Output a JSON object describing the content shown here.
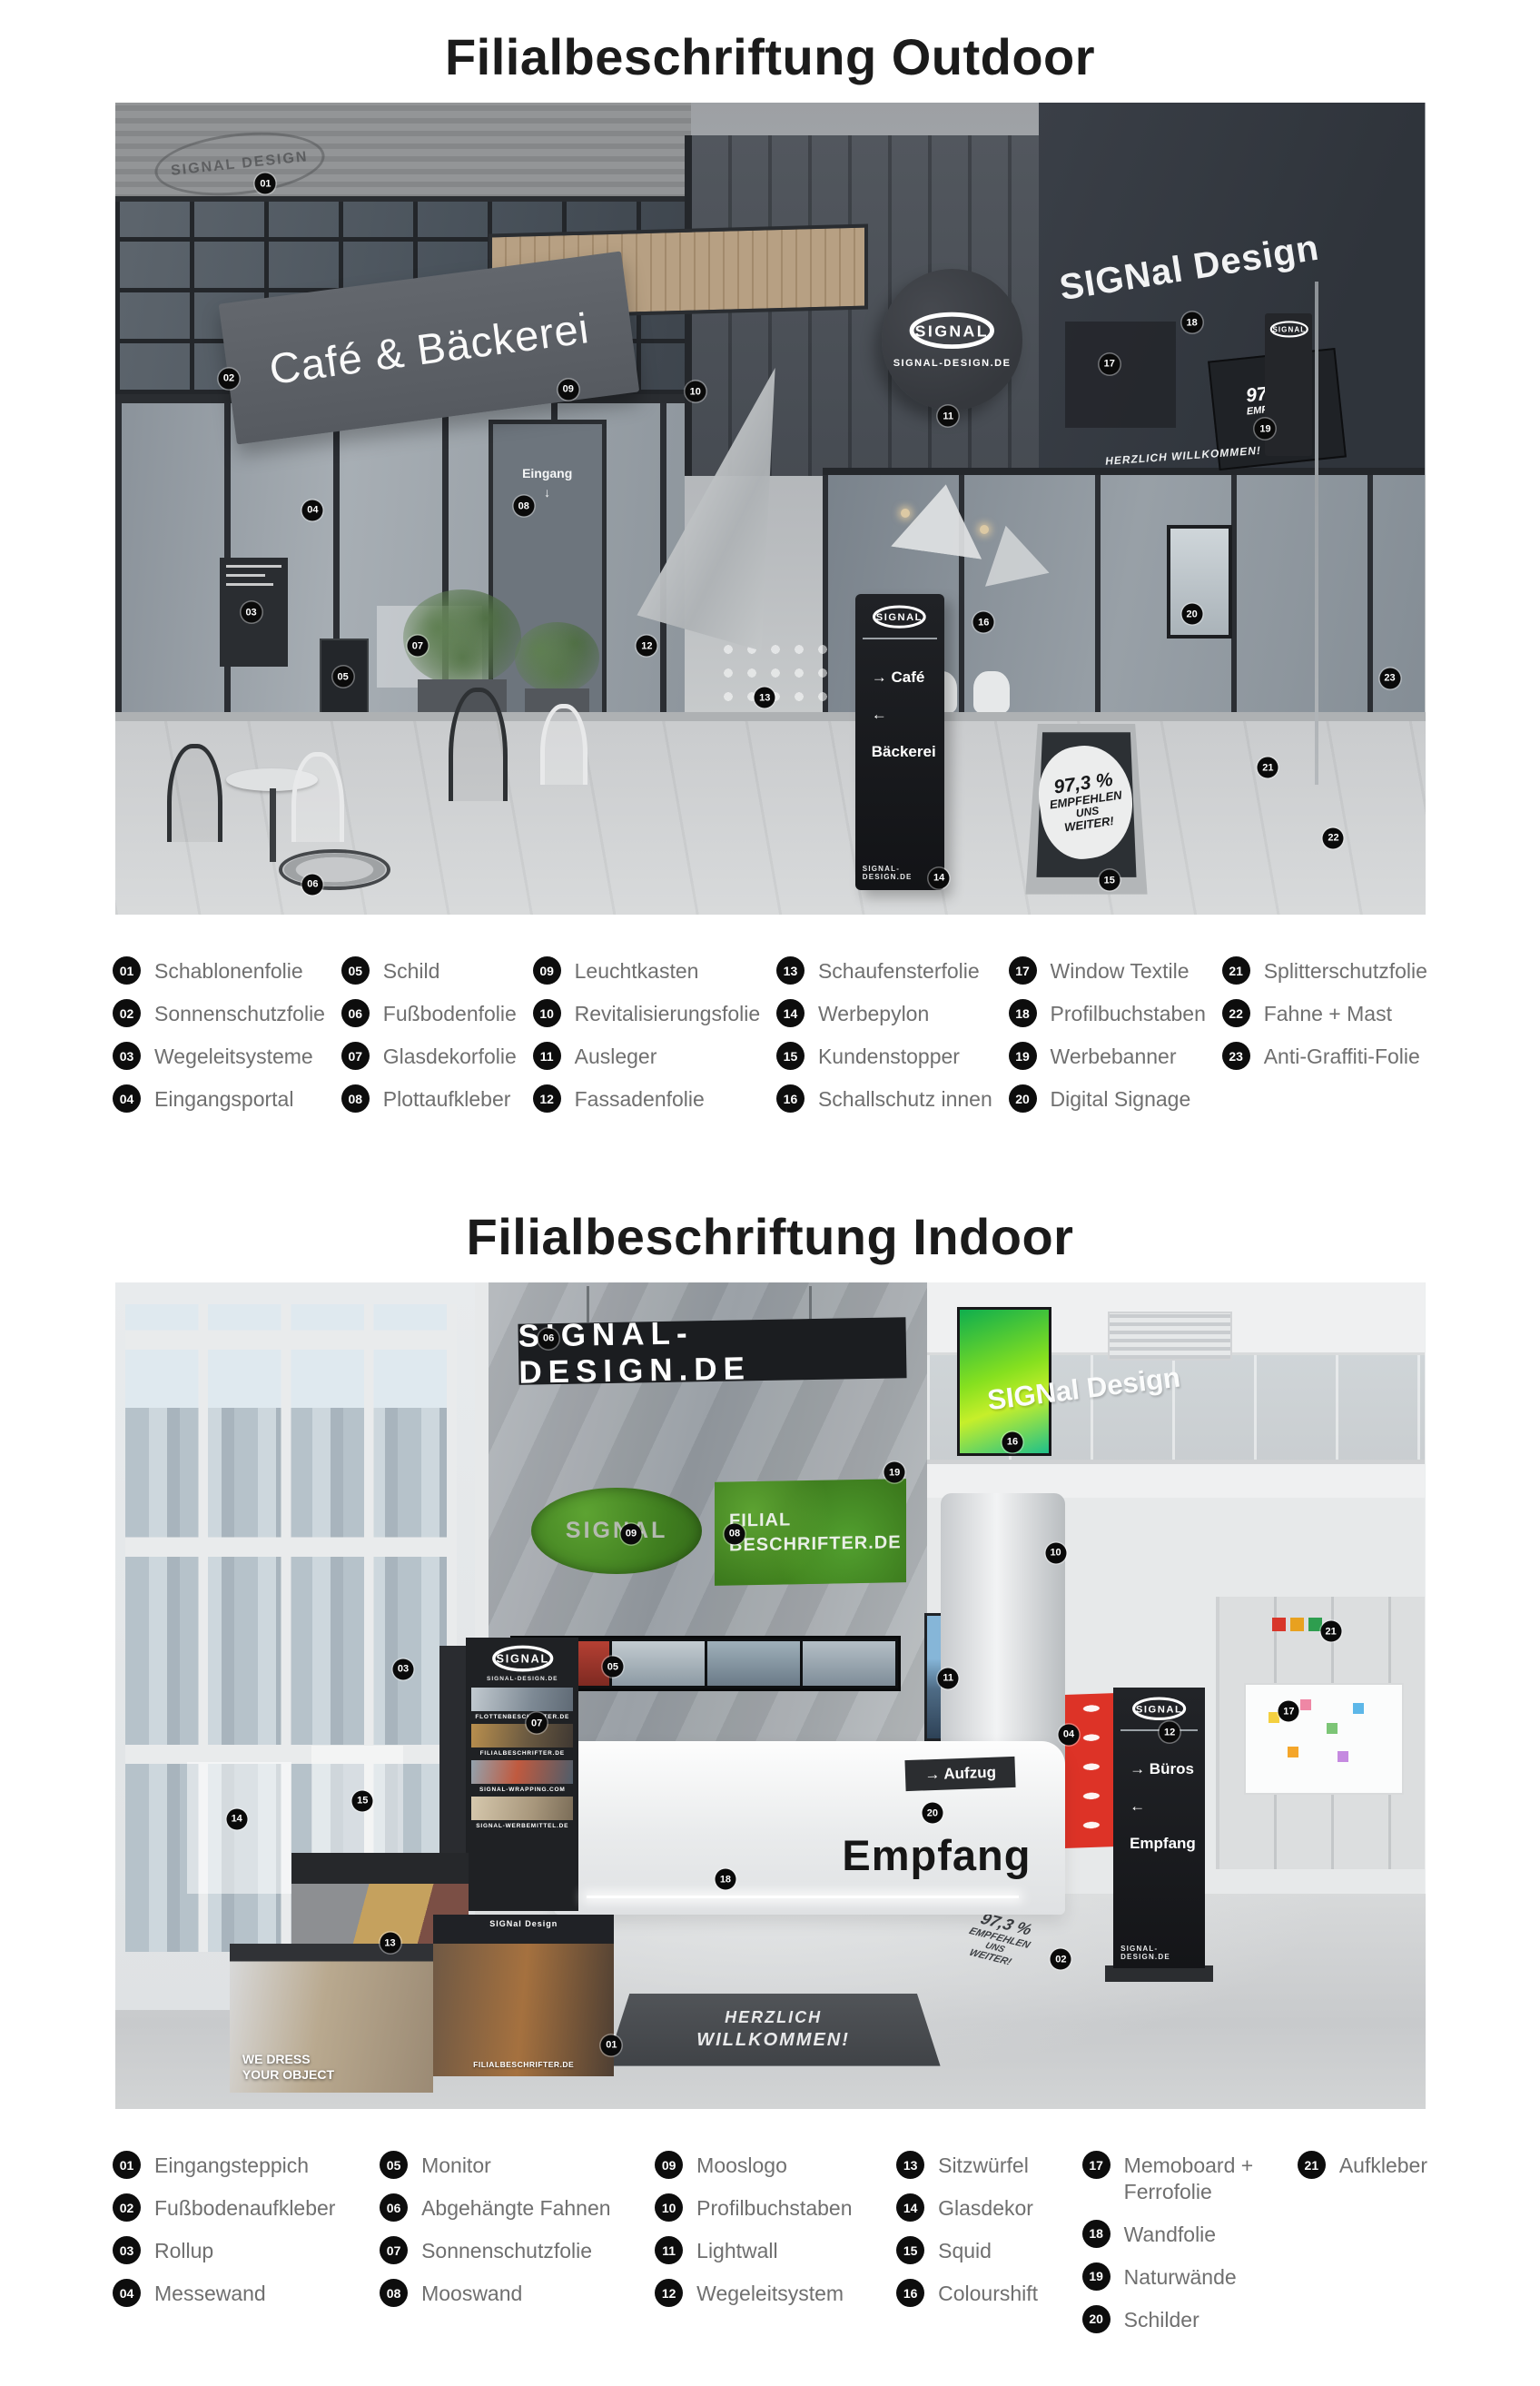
{
  "brand": {
    "logo_text": "SIGNAL",
    "domain": "SIGNAL-DESIGN.DE"
  },
  "colors": {
    "title_text": "#1b1b1b",
    "legend_text": "#6f6f6f",
    "badge": "#0d0d0d",
    "sign_dark": "#1f2226",
    "moss_green": "#4f9a2e",
    "messewand_red": "#dd3327",
    "colourshift_green": "#86e01f"
  },
  "outdoor": {
    "title": "Filialbeschriftung Outdoor",
    "scene": {
      "stencil": "SIGNAL DESIGN",
      "cafe_sign": "Café & Bäckerei",
      "eingang": "Eingang",
      "eingang_arrow": "↓",
      "facade_letters": "SIGNal Design",
      "window_welcome": "HERZLICH WILLKOMMEN!",
      "pylon": {
        "line1": "→ Café",
        "line2": "← Bäckerei"
      },
      "stopper": {
        "l1": "97,3 %",
        "l2": "EMPFEHLEN",
        "l3": "UNS",
        "l4": "WEITER!"
      },
      "banner": {
        "l1": "97,3 %",
        "l2": "EMPFEHLEN",
        "l3": "UNS",
        "l4": "WEITER!"
      }
    },
    "markers": [
      {
        "n": "01",
        "x": 11.5,
        "y": 10.0
      },
      {
        "n": "02",
        "x": 8.7,
        "y": 34.0
      },
      {
        "n": "03",
        "x": 10.4,
        "y": 62.8
      },
      {
        "n": "04",
        "x": 15.1,
        "y": 50.2
      },
      {
        "n": "05",
        "x": 17.4,
        "y": 70.7
      },
      {
        "n": "06",
        "x": 15.1,
        "y": 96.3
      },
      {
        "n": "07",
        "x": 23.1,
        "y": 66.9
      },
      {
        "n": "08",
        "x": 31.2,
        "y": 49.7
      },
      {
        "n": "09",
        "x": 34.6,
        "y": 35.3
      },
      {
        "n": "10",
        "x": 44.3,
        "y": 35.6
      },
      {
        "n": "11",
        "x": 63.6,
        "y": 38.6
      },
      {
        "n": "12",
        "x": 40.6,
        "y": 66.9
      },
      {
        "n": "13",
        "x": 49.6,
        "y": 73.3
      },
      {
        "n": "14",
        "x": 62.9,
        "y": 95.5
      },
      {
        "n": "15",
        "x": 75.9,
        "y": 95.8
      },
      {
        "n": "16",
        "x": 66.3,
        "y": 64.0
      },
      {
        "n": "17",
        "x": 75.9,
        "y": 32.2
      },
      {
        "n": "18",
        "x": 82.2,
        "y": 27.1
      },
      {
        "n": "19",
        "x": 87.8,
        "y": 40.2
      },
      {
        "n": "20",
        "x": 82.2,
        "y": 63.0
      },
      {
        "n": "21",
        "x": 88.0,
        "y": 81.9
      },
      {
        "n": "22",
        "x": 93.0,
        "y": 90.6
      },
      {
        "n": "23",
        "x": 97.3,
        "y": 70.9
      }
    ],
    "legend": {
      "c1": [
        {
          "num": "01",
          "label": "Schablonenfolie"
        },
        {
          "num": "02",
          "label": "Sonnenschutzfolie"
        },
        {
          "num": "03",
          "label": "Wegeleitsysteme"
        },
        {
          "num": "04",
          "label": "Eingangsportal"
        }
      ],
      "c2": [
        {
          "num": "05",
          "label": "Schild"
        },
        {
          "num": "06",
          "label": "Fußbodenfolie"
        },
        {
          "num": "07",
          "label": "Glasdekorfolie"
        },
        {
          "num": "08",
          "label": "Plottaufkleber"
        }
      ],
      "c3": [
        {
          "num": "09",
          "label": "Leuchtkasten"
        },
        {
          "num": "10",
          "label": "Revitalisierungsfolie"
        },
        {
          "num": "11",
          "label": "Ausleger"
        },
        {
          "num": "12",
          "label": "Fassadenfolie"
        }
      ],
      "c4": [
        {
          "num": "13",
          "label": "Schaufensterfolie"
        },
        {
          "num": "14",
          "label": "Werbepylon"
        },
        {
          "num": "15",
          "label": "Kundenstopper"
        },
        {
          "num": "16",
          "label": "Schallschutz innen"
        }
      ],
      "c5": [
        {
          "num": "17",
          "label": "Window Textile"
        },
        {
          "num": "18",
          "label": "Profilbuchstaben"
        },
        {
          "num": "19",
          "label": "Werbebanner"
        },
        {
          "num": "20",
          "label": "Digital Signage"
        }
      ],
      "c6": [
        {
          "num": "21",
          "label": "Splitterschutzfolie"
        },
        {
          "num": "22",
          "label": "Fahne + Mast"
        },
        {
          "num": "23",
          "label": "Anti-Graffiti-Folie"
        }
      ]
    }
  },
  "indoor": {
    "title": "Filialbeschriftung Indoor",
    "scene": {
      "hang_banner": "SIGNAL-DESIGN.DE",
      "moss_wall": {
        "l1": "FILIAL",
        "l2": "BESCHRIFTER.DE"
      },
      "balcony_letters": "SIGNal Design",
      "empfang": "Empfang",
      "aufzug": "→ Aufzug",
      "pylon": {
        "line1": "→ Büros",
        "line2": "← Empfang"
      },
      "mat": {
        "l1": "HERZLICH",
        "l2": "WILLKOMMEN!"
      },
      "sticker": {
        "l1": "97,3 %",
        "l2": "EMPFEHLEN",
        "l3": "UNS",
        "l4": "WEITER!"
      },
      "cube_back": {
        "label": "FILIALBESCHRIFTER.DE"
      },
      "cube_front": {
        "l1": "WE DRESS",
        "l2": "YOUR OBJECT"
      },
      "cube_right": {
        "top": "SIGNal Design",
        "label": "FILIALBESCHRIFTER.DE"
      },
      "rollup_strips": [
        {
          "label": "FLOTTENBESCHRIFTER.DE",
          "bg": "linear-gradient(100deg,#c2cad0,#7d8994 60%,#5f6a75)"
        },
        {
          "label": "FILIALBESCHRIFTER.DE",
          "bg": "linear-gradient(100deg,#b98f4e,#6b5a41 55%,#3f3832)"
        },
        {
          "label": "SIGNAL-WRAPPING.COM",
          "bg": "linear-gradient(100deg,#93a2ad,#c05a3f 45%,#4f5d6a)"
        },
        {
          "label": "SIGNAL-WERBEMITTEL.DE",
          "bg": "linear-gradient(100deg,#d6c8ad,#a8977c 60%,#7b6d58)"
        }
      ],
      "monitor_segments": [
        {
          "bg": "linear-gradient(#b54033,#7e2a22)"
        },
        {
          "bg": "linear-gradient(#c3ccd1,#8d9aa4)"
        },
        {
          "bg": "linear-gradient(#9fb0ba,#6b7b88)"
        },
        {
          "bg": "linear-gradient(#b4bfc6,#7f8d99)"
        }
      ],
      "memo_notes": [
        {
          "bg": "#f4d03f",
          "x": 18,
          "y": 30
        },
        {
          "bg": "#ef87a5",
          "x": 38,
          "y": 18
        },
        {
          "bg": "#7cc576",
          "x": 55,
          "y": 40
        },
        {
          "bg": "#5db7e8",
          "x": 72,
          "y": 22
        },
        {
          "bg": "#f4a62a",
          "x": 30,
          "y": 62
        },
        {
          "bg": "#c58ae0",
          "x": 62,
          "y": 66
        }
      ],
      "exit_sticker_colors": [
        {
          "bg": "#d8362a"
        },
        {
          "bg": "#e8a11f"
        },
        {
          "bg": "#2e9e4f"
        }
      ]
    },
    "markers": [
      {
        "n": "01",
        "x": 37.9,
        "y": 92.3
      },
      {
        "n": "02",
        "x": 72.2,
        "y": 81.9
      },
      {
        "n": "03",
        "x": 22.0,
        "y": 46.8
      },
      {
        "n": "04",
        "x": 72.8,
        "y": 54.7
      },
      {
        "n": "05",
        "x": 38.0,
        "y": 46.5
      },
      {
        "n": "06",
        "x": 33.1,
        "y": 6.8
      },
      {
        "n": "07",
        "x": 32.2,
        "y": 53.3
      },
      {
        "n": "08",
        "x": 47.3,
        "y": 30.4
      },
      {
        "n": "09",
        "x": 39.4,
        "y": 30.4
      },
      {
        "n": "10",
        "x": 71.8,
        "y": 32.7
      },
      {
        "n": "11",
        "x": 63.6,
        "y": 47.9
      },
      {
        "n": "12",
        "x": 80.5,
        "y": 54.4
      },
      {
        "n": "13",
        "x": 21.0,
        "y": 79.9
      },
      {
        "n": "14",
        "x": 9.3,
        "y": 64.9
      },
      {
        "n": "15",
        "x": 18.9,
        "y": 62.7
      },
      {
        "n": "16",
        "x": 68.5,
        "y": 19.3
      },
      {
        "n": "17",
        "x": 89.6,
        "y": 51.9
      },
      {
        "n": "18",
        "x": 46.6,
        "y": 72.2
      },
      {
        "n": "19",
        "x": 59.5,
        "y": 23.0
      },
      {
        "n": "20",
        "x": 62.4,
        "y": 64.2
      },
      {
        "n": "21",
        "x": 92.8,
        "y": 42.2
      }
    ],
    "legend": {
      "c1": [
        {
          "num": "01",
          "label": "Eingangsteppich"
        },
        {
          "num": "02",
          "label": "Fußbodenaufkleber"
        },
        {
          "num": "03",
          "label": "Rollup"
        },
        {
          "num": "04",
          "label": "Messewand"
        }
      ],
      "c2": [
        {
          "num": "05",
          "label": "Monitor"
        },
        {
          "num": "06",
          "label": "Abgehängte Fahnen"
        },
        {
          "num": "07",
          "label": "Sonnenschutzfolie"
        },
        {
          "num": "08",
          "label": "Mooswand"
        }
      ],
      "c3": [
        {
          "num": "09",
          "label": "Mooslogo"
        },
        {
          "num": "10",
          "label": "Profilbuchstaben"
        },
        {
          "num": "11",
          "label": "Lightwall"
        },
        {
          "num": "12",
          "label": "Wegeleitsystem"
        }
      ],
      "c4": [
        {
          "num": "13",
          "label": "Sitzwürfel"
        },
        {
          "num": "14",
          "label": "Glasdekor"
        },
        {
          "num": "15",
          "label": "Squid"
        },
        {
          "num": "16",
          "label": "Colourshift"
        }
      ],
      "c5": [
        {
          "num": "17",
          "label": "Memoboard +\nFerrofolie"
        },
        {
          "num": "18",
          "label": "Wandfolie"
        },
        {
          "num": "19",
          "label": "Naturwände"
        },
        {
          "num": "20",
          "label": "Schilder"
        }
      ],
      "c6": [
        {
          "num": "21",
          "label": "Aufkleber"
        }
      ]
    }
  }
}
